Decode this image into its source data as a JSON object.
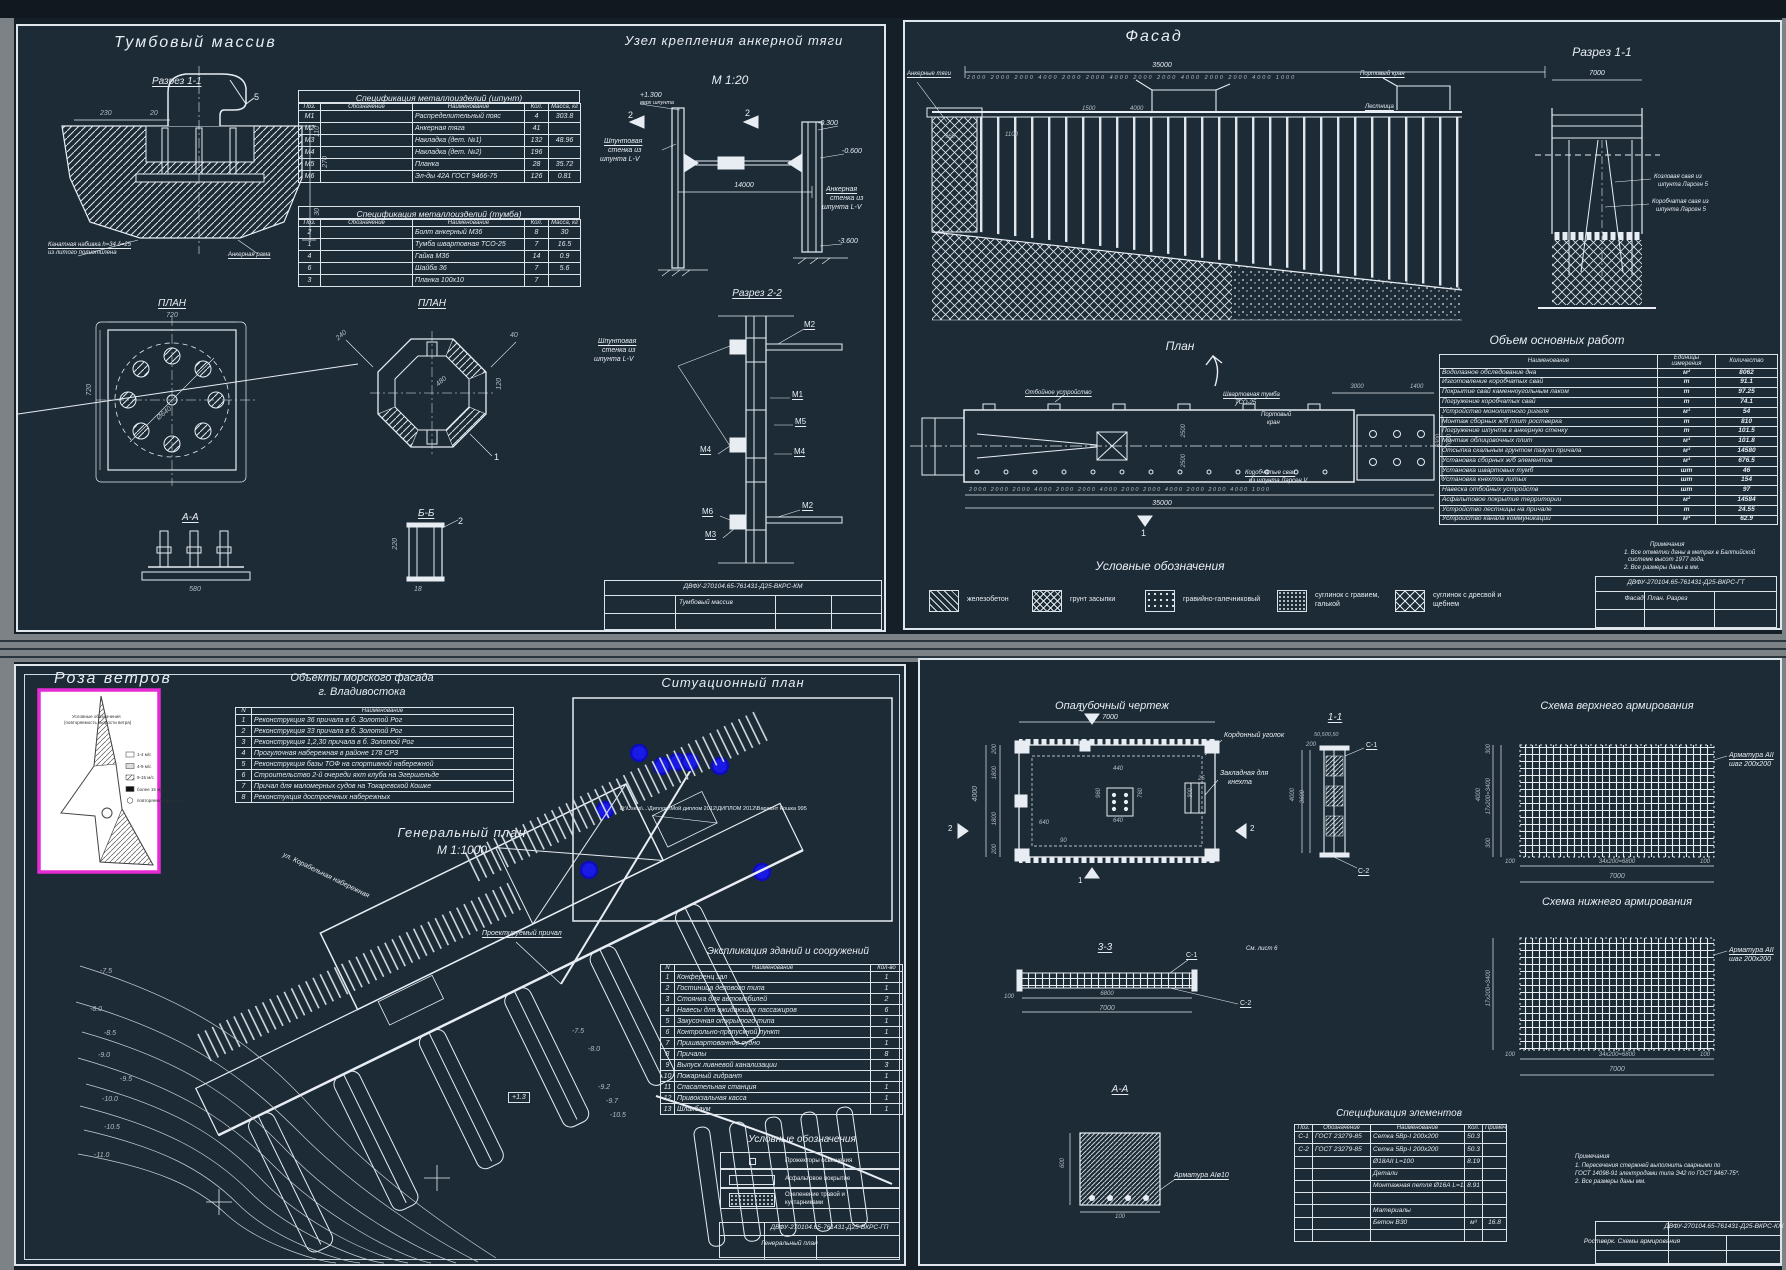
{
  "colors": {
    "canvas": "#1d2b37",
    "line": "#e7edf2",
    "dim_gray": "#b3bcc3",
    "magenta": "#e62ad4",
    "marker_blue": "#1a1ae6",
    "frame_gray": "#7d8287"
  },
  "tl": {
    "title": "Тумбовый массив",
    "sec11": "Разрез 1-1",
    "plan_sq": "ПЛАН",
    "plan_oct": "ПЛАН",
    "secAA": "А-А",
    "secBB": "Б-Б",
    "uzel_title": "Узел крепления анкерной тяги",
    "scale": "М 1:20",
    "sec22": "Разрез 2-2",
    "dims": {
      "d230": "230",
      "d20": "20",
      "d110": "110",
      "d270": "270",
      "d30": "30",
      "c5": "5",
      "d720a": "720",
      "d720b": "720",
      "d640": "Ø640",
      "d240": "240",
      "d480": "480",
      "d120": "120",
      "d40": "40",
      "c1": "1",
      "d580": "580",
      "d18": "18",
      "d220": "220",
      "c2": "2",
      "d14000": "14000",
      "e1300": "+1.300",
      "e1300b": "верх шпунта",
      "e0300": "-0.300",
      "e0600": "-0.600",
      "e3600": "-3.600",
      "f2a": "2",
      "f2b": "2"
    },
    "notes": {
      "wrap1": "Канатная набивка h=34 δ=25",
      "wrap2": "из литого полиэтилена",
      "anchor": "Анкерная рама"
    },
    "wall": {
      "l1": "Шпунтовая",
      "l2": "стенка из",
      "l3": "шпунта L-V"
    },
    "awall": {
      "l1": "Анкерная",
      "l2": "стенка из",
      "l3": "шпунта L-V"
    },
    "wall2": {
      "l1": "Шпунтовая",
      "l2": "стенка из",
      "l3": "шпунта L-V"
    },
    "marks": {
      "m2a": "М2",
      "m1": "М1",
      "m5": "М5",
      "m4a": "М4",
      "m4b": "М4",
      "m6": "М6",
      "m3": "М3",
      "m2b": "М2"
    },
    "spec1": {
      "title": "Спецификация металлоизделий (шпунт)",
      "headers": [
        "Поз.",
        "Обозначение",
        "Наименование",
        "Кол.",
        "Масса, кг"
      ],
      "rows": [
        [
          "М1",
          "",
          "Распределительный пояс",
          "4",
          "303.8"
        ],
        [
          "М2",
          "",
          "Анкерная тяга",
          "41",
          ""
        ],
        [
          "М3",
          "",
          "Накладка (дет. №1)",
          "132",
          "48.96"
        ],
        [
          "М4",
          "",
          "Накладка (дет. №2)",
          "196",
          ""
        ],
        [
          "М5",
          "",
          "Планка",
          "28",
          "35.72"
        ],
        [
          "М6",
          "",
          "Эл-ды 42А ГОСТ 9466-75",
          "126",
          "0.81"
        ]
      ]
    },
    "spec2": {
      "title": "Спецификация металлоизделий (тумба)",
      "headers": [
        "Поз.",
        "Обозначение",
        "Наименование",
        "Кол.",
        "Масса, кг"
      ],
      "rows": [
        [
          "2",
          "",
          "Болт анкерный М36",
          "8",
          "30"
        ],
        [
          "1",
          "",
          "Тумба швартовная ТСО-25",
          "7",
          "16.5"
        ],
        [
          "4",
          "",
          "Гайка М36",
          "14",
          "0.9"
        ],
        [
          "6",
          "",
          "Шайба 36",
          "7",
          "5.6"
        ],
        [
          "3",
          "",
          "Планка 100х10",
          "7",
          ""
        ]
      ]
    },
    "stamp": {
      "doc": "ДВФУ-270104.65-761431-Д25-ВКРС-КМ",
      "name": "Тумбовый массив"
    }
  },
  "tr": {
    "title": "Фасад",
    "d35000": "35000",
    "dims_top": "2000 2000 2000   4000   2000 2000   4000   2000 2000   4000   2000 2000   4000   1000",
    "anchor": "Анкерные тяги",
    "crane": "Портовый кран",
    "ladder": "Лестница",
    "d960": "960",
    "d1100": "1100",
    "d1500": "1500",
    "d4000": "4000",
    "sec11": "Разрез 1-1",
    "d7000": "7000",
    "pile1a": "Козловая свая из",
    "pile1b": "шпунта Ларсен 5",
    "pile2a": "Коробчатая свая из",
    "pile2b": "шпунта Ларсен 5",
    "plan": "План",
    "fender": "Отбойное устройство",
    "bollard1": "Швартовная тумба",
    "bollard2": "ТСО-25",
    "crane2a": "Портовый",
    "crane2b": "кран",
    "piles1": "Коробчатые сваи",
    "piles2": "из шпунта Ларсен V",
    "d3000": "3000",
    "d1400": "1400",
    "d2500a": "2500",
    "d2500b": "2500",
    "d6300": "6300",
    "d7000b": "7000",
    "d35000b": "35000",
    "dims_bot": "2000 2000 2000   4000   2000 2000   4000   2000 2000   4000   2000 2000   4000   1000",
    "f1": "1",
    "volume": {
      "title": "Объем основных работ",
      "headers": [
        "Наименование",
        "Единицы измерения",
        "Количество"
      ],
      "rows": [
        [
          "Водолазное обследование дна",
          "м²",
          "8062"
        ],
        [
          "Изготовление коробчатых свай",
          "т",
          "91.1"
        ],
        [
          "Покрытие свай каменноугольным лаком",
          "т",
          "97.25"
        ],
        [
          "Погружение коробчатых свай",
          "т",
          "74.1"
        ],
        [
          "Устройство монолитного ригеля",
          "м³",
          "54"
        ],
        [
          "Монтаж сборных ж/б плит ростверка",
          "т",
          "810"
        ],
        [
          "Погружение шпунта в анкерную стенку",
          "т",
          "101.5"
        ],
        [
          "Монтаж облицовочных плит",
          "м³",
          "101.8"
        ],
        [
          "Отсыпка скальным грунтом пазухи причала",
          "м³",
          "14580"
        ],
        [
          "Установка сборных ж/б элементов",
          "м³",
          "676.5"
        ],
        [
          "Установка швартовых тумб",
          "шт",
          "46"
        ],
        [
          "Установка кнехтов литых",
          "шт",
          "154"
        ],
        [
          "Навеска отбойных устройств",
          "шт",
          "97"
        ],
        [
          "Асфальтовое покрытие территории",
          "м²",
          "14584"
        ],
        [
          "Устройство лестницы на причале",
          "т",
          "24.55"
        ],
        [
          "Устройство канала коммуникаций",
          "м³",
          "62.9"
        ]
      ]
    },
    "legend_title": "Условные обозначения",
    "legend": {
      "l1": "железобетон",
      "l2": "грунт засыпки",
      "l3": "гравийно-галечниковый",
      "l4a": "суглинок с гравием,",
      "l4b": "галькой",
      "l5a": "суглинок с дресвой и",
      "l5b": "щебнем"
    },
    "notes": {
      "t": "Примечания",
      "n1": "1. Все отметки даны в метрах в Балтийской",
      "n2": "системе высот 1977 года.",
      "n3": "2. Все размеры даны в мм."
    },
    "stamp": {
      "doc": "ДВФУ-270104.65-761431-Д25-ВКРС-ГТ",
      "name": "Фасад. План. Разрез"
    }
  },
  "bl": {
    "rose_title": "Роза ветров",
    "rose": {
      "t1": "Условные обозначения",
      "t2": "(повторяемость скорости ветра)",
      "l1": "1-4 м/с",
      "l2": "4-9 м/с",
      "l3": "9-15 м/с",
      "l4": "более 15 м/с",
      "l5": "повторяемость штиля"
    },
    "objects_t1": "Объекты морского фасада",
    "objects_t2": "г. Владивостока",
    "objects": {
      "headers": [
        "N",
        "Наименование"
      ],
      "rows": [
        [
          "1",
          "Реконструкция 36 причала в б. Золотой Рог"
        ],
        [
          "2",
          "Реконструкция 33 причала в б. Золотой Рог"
        ],
        [
          "3",
          "Реконструкция 1,2,30 причала в б. Золотой Рог"
        ],
        [
          "4",
          "Прогулочная набережная в районе 178 СРЗ"
        ],
        [
          "5",
          "Реконструкция базы ТОФ на спортивной набережной"
        ],
        [
          "6",
          "Строительство 2-й очереди яхт клуба на Эгершельде"
        ],
        [
          "7",
          "Причал для маломерных судов на Токаревской Кошке"
        ],
        [
          "8",
          "Реконстукция достроечных набережных"
        ]
      ]
    },
    "sit_title": "Ситуационный план",
    "file_path": "D:\\Users\\...\\Диплом\\Мой диплом 2012\\ДИПЛОМ 2012\\Вариант Кошка 995",
    "genplan1": "Генеральный план",
    "genplan2": "М 1:1000",
    "street": "ул. Корабельная набережная",
    "pier_label": "Проектируемый причал",
    "contours": {
      "c75": "-7.5",
      "c80": "-8.0",
      "c85": "-8.5",
      "c90": "-9.0",
      "c95": "-9.5",
      "c100": "-10.0",
      "c105": "-10.5",
      "c110": "-11.0",
      "c75r": "-7.5",
      "c80r": "-8.0",
      "c92": "-9.2",
      "c97": "-9.7",
      "c105r": "-10.5",
      "e13": "+1.3"
    },
    "expl_title": "Экспликация зданий и сооружений",
    "expl": {
      "headers": [
        "N",
        "Наименование",
        "Кол-во"
      ],
      "rows": [
        [
          "1",
          "Конференц зал",
          "1"
        ],
        [
          "2",
          "Гостиница делового типа",
          "1"
        ],
        [
          "3",
          "Стоянка для автомобилей",
          "2"
        ],
        [
          "4",
          "Навесы для ожидающих пассажиров",
          "6"
        ],
        [
          "5",
          "Закусочная открытого типа",
          "1"
        ],
        [
          "6",
          "Контрольно-пропускной пункт",
          "1"
        ],
        [
          "7",
          "Пришвартованное судно",
          "1"
        ],
        [
          "8",
          "Причалы",
          "8"
        ],
        [
          "9",
          "Выпуск ливневой канализации",
          "3"
        ],
        [
          "10",
          "Пожарный гидрант",
          "1"
        ],
        [
          "11",
          "Спасательная станция",
          "1"
        ],
        [
          "12",
          "Привокзальная касса",
          "1"
        ],
        [
          "13",
          "Шлакбаум",
          "1"
        ]
      ]
    },
    "leg_title": "Условные обозначения",
    "legend": {
      "l1": "Прожекторы освещения",
      "l2": "Асфальтовое покрытие",
      "l3a": "Озеленение травой и",
      "l3b": "кустарниками"
    },
    "stamp": {
      "doc": "ДВФУ-270104.65-761431-Д25-ВКРС-ГП",
      "name": "Генеральный план"
    }
  },
  "br": {
    "form_title": "Опалубочный чертеж",
    "dims": {
      "d7000": "7000",
      "d4000": "4000",
      "d200a": "200",
      "d1800a": "1800",
      "d1800b": "1800",
      "d200b": "200",
      "d640a": "640",
      "d440": "440",
      "d960": "960",
      "d760": "760",
      "d640b": "640",
      "d90": "90",
      "d25": "25",
      "d300": "300",
      "d50": "50,500,50",
      "d4000b": "4000",
      "d3600": "3600",
      "d200c": "200",
      "d300t": "300",
      "d300b": "300",
      "dv": "17х200=3400",
      "d4000c": "4000",
      "d100l": "100",
      "dh": "34х200=6800",
      "d100r": "100",
      "d7000c": "7000",
      "dv2": "17х200=3400",
      "d100l2": "100",
      "dh2": "34х200=6800",
      "d100r2": "100",
      "d7000d": "7000",
      "d100s": "100",
      "d6800": "6800",
      "d7000e": "7000",
      "d600": "600",
      "d100a": "100",
      "f1": "1",
      "f2": "2"
    },
    "corner": "Кордонный уголок",
    "embed1": "Закладная для",
    "embed2": "кнехта",
    "sec11": "1-1",
    "s1": "С-1",
    "s2": "С-2",
    "top_scheme": "Схема верхнего армирования",
    "bot_scheme": "Схема нижнего армирования",
    "arm1a": "Арматура АII",
    "arm1b": "шаг 200х200",
    "arm2a": "Арматура АII",
    "arm2b": "шаг 200х200",
    "sec33": "3-3",
    "see6": "См. лист 6",
    "s1b": "С-1",
    "s2b": "С-2",
    "secAA": "А-А",
    "rebar": "Арматура АIø10",
    "spec": {
      "title": "Спецификация элементов",
      "headers": [
        "Поз.",
        "Обозначение",
        "Наименование",
        "Кол.",
        "Примечание"
      ],
      "rows": [
        [
          "С-1",
          "ГОСТ 23279-85",
          "Сетка 5Вр-I 200х200",
          "50.3",
          ""
        ],
        [
          "С-2",
          "ГОСТ 23279-85",
          "Сетка 5Вр-I 200х200",
          "50.3",
          ""
        ],
        [
          "",
          "",
          "Ø18АII L=100",
          "8.19",
          ""
        ],
        [
          "",
          "",
          "Детали",
          "",
          ""
        ],
        [
          "",
          "",
          "Монтажная петля Ø16А L=1150",
          "8.91",
          ""
        ],
        [
          "",
          "",
          "",
          "",
          ""
        ],
        [
          "",
          "",
          "Материалы",
          "",
          ""
        ],
        [
          "",
          "",
          "Бетон В30",
          "м³",
          "16.8"
        ],
        [
          "",
          "",
          "",
          "",
          ""
        ]
      ]
    },
    "notes": {
      "t": "Примечания",
      "n1": "1. Пересечения стержней выполнить сварными по",
      "n2": "ГОСТ 14098-91 электродами типа Э42 по ГОСТ 9467-75*.",
      "n3": "2. Все размеры даны мм."
    },
    "stamp": {
      "doc": "ДВФУ-270104.65-761431-Д25-ВКРС-КЖ",
      "name": "Ростверк. Схемы армирования"
    }
  }
}
